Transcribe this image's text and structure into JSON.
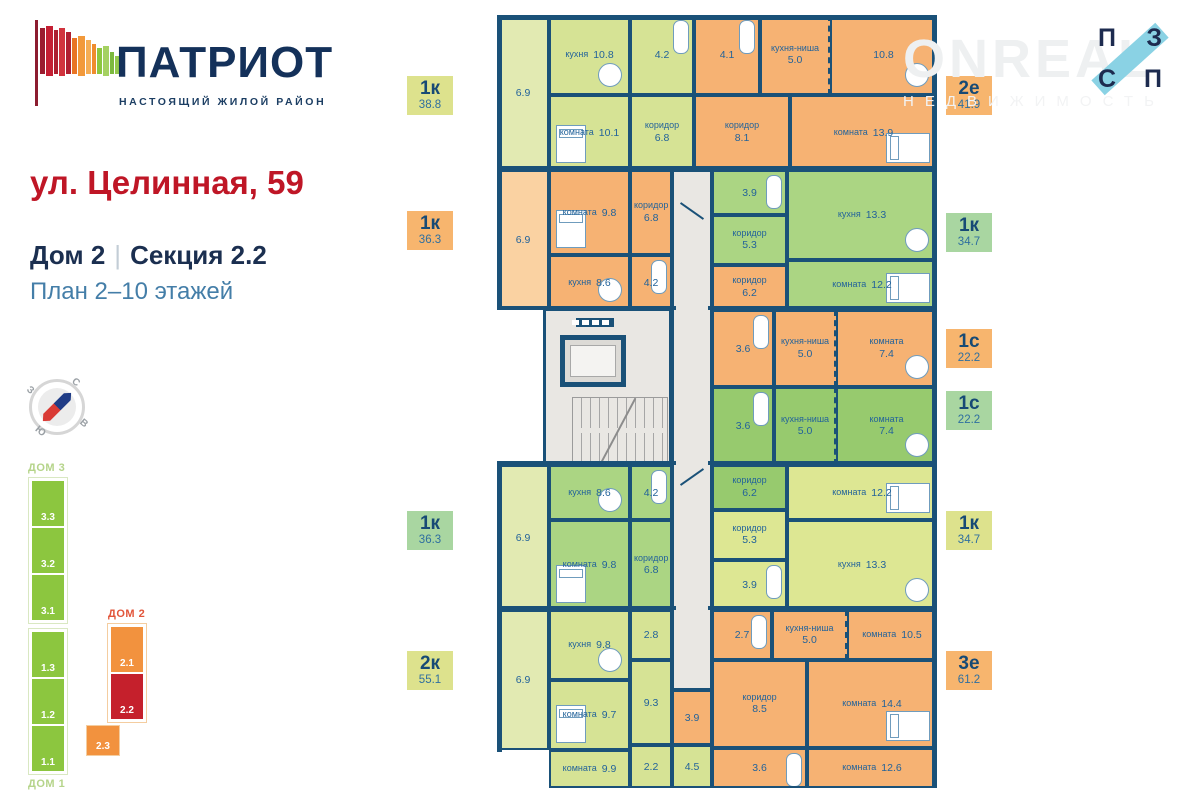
{
  "brand": {
    "name": "ПАТРИОТ",
    "tagline": "НАСТОЯЩИЙ ЖИЛОЙ РАЙОН",
    "flag_bars": [
      {
        "c": "#9b1c2f",
        "h": 46,
        "t": 8,
        "w": 5
      },
      {
        "c": "#c41f33",
        "h": 50,
        "t": 6,
        "w": 7
      },
      {
        "c": "#ad1e2f",
        "h": 44,
        "t": 10,
        "w": 4
      },
      {
        "c": "#d1343e",
        "h": 48,
        "t": 8,
        "w": 6
      },
      {
        "c": "#b01f31",
        "h": 42,
        "t": 12,
        "w": 5
      },
      {
        "c": "#e87424",
        "h": 36,
        "t": 18,
        "w": 5
      },
      {
        "c": "#f2993b",
        "h": 40,
        "t": 16,
        "w": 7
      },
      {
        "c": "#f5ad55",
        "h": 34,
        "t": 20,
        "w": 5
      },
      {
        "c": "#ef8c2e",
        "h": 30,
        "t": 24,
        "w": 4
      },
      {
        "c": "#8dc63f",
        "h": 26,
        "t": 28,
        "w": 5
      },
      {
        "c": "#a5d162",
        "h": 30,
        "t": 26,
        "w": 6
      },
      {
        "c": "#7cb93e",
        "h": 22,
        "t": 32,
        "w": 4
      },
      {
        "c": "#93c84c",
        "h": 18,
        "t": 36,
        "w": 5
      }
    ]
  },
  "title": {
    "address": "ул. Целинная, 59",
    "house": "Дом 2",
    "section": "Секция 2.2",
    "floors": "План 2–10 этажей"
  },
  "compass": {
    "n": "С",
    "e": "В",
    "s": "Ю",
    "w": "З"
  },
  "watermark": {
    "line1": "ONREAL",
    "line2": "НЕДВИЖИМОСТЬ"
  },
  "corner_logo": {
    "tl": "П",
    "tr": "З",
    "bl": "С",
    "br": "П",
    "band_color": "#8ad2e4"
  },
  "site_plan": {
    "dom3": {
      "label": "ДОМ 3",
      "sections": [
        "3.3",
        "3.2",
        "3.1"
      ]
    },
    "dom1": {
      "label": "ДОМ 1",
      "sections": [
        "1.3",
        "1.2",
        "1.1"
      ]
    },
    "dom2": {
      "label": "ДОМ 2",
      "sections_main": [
        "2.1",
        "2.2"
      ],
      "section_offset": "2.3",
      "highlight": "2.2",
      "color_normal": "#f2923e",
      "color_highlight": "#c5202c"
    }
  },
  "palette": {
    "y": "#d6e395",
    "yb": "#e2eab2",
    "o": "#f6b273",
    "ob": "#fad2a2",
    "g": "#abd583",
    "gs": "#97ca6e",
    "y2": "#dde793",
    "wall": "#1a5178",
    "text": "#23639a"
  },
  "tags_left": [
    {
      "t": "1к",
      "a": "38.8",
      "c": "#dde28d",
      "y": 76
    },
    {
      "t": "1к",
      "a": "36.3",
      "c": "#f7b56e",
      "y": 211
    },
    {
      "t": "1к",
      "a": "36.3",
      "c": "#a9d6a1",
      "y": 511
    },
    {
      "t": "2к",
      "a": "55.1",
      "c": "#dde28d",
      "y": 651
    }
  ],
  "tags_right": [
    {
      "t": "2е",
      "a": "41.9",
      "c": "#f7b56e",
      "y": 76
    },
    {
      "t": "1к",
      "a": "34.7",
      "c": "#a9d6a1",
      "y": 213
    },
    {
      "t": "1с",
      "a": "22.2",
      "c": "#f7b56e",
      "y": 329
    },
    {
      "t": "1с",
      "a": "22.2",
      "c": "#a9d6a1",
      "y": 391
    },
    {
      "t": "1к",
      "a": "34.7",
      "c": "#dde28d",
      "y": 511
    },
    {
      "t": "3е",
      "a": "61.2",
      "c": "#f7b56e",
      "y": 651
    }
  ],
  "plan": {
    "rooms": [
      {
        "a": "6.9",
        "x": 0,
        "y": 0,
        "w": 52,
        "h": 155,
        "f": "yb",
        "v": 1,
        "b": 1
      },
      {
        "n": "кухня",
        "a": "10.8",
        "x": 52,
        "y": 0,
        "w": 81,
        "h": 80,
        "f": "y",
        "furn": "table"
      },
      {
        "n": "комната",
        "a": "10.1",
        "x": 52,
        "y": 80,
        "w": 81,
        "h": 75,
        "f": "y",
        "furn": "bed"
      },
      {
        "a": "4.2",
        "x": 133,
        "y": 0,
        "w": 64,
        "h": 80,
        "f": "y",
        "furn": "bath"
      },
      {
        "n": "коридор",
        "a": "6.8",
        "x": 133,
        "y": 80,
        "w": 64,
        "h": 75,
        "f": "y",
        "v": 1
      },
      {
        "a": "4.1",
        "x": 197,
        "y": 0,
        "w": 66,
        "h": 80,
        "f": "o",
        "furn": "bath"
      },
      {
        "n": "кухня-ниша",
        "a": "5.0",
        "x": 263,
        "y": 0,
        "w": 70,
        "h": 80,
        "f": "o",
        "v": 1,
        "dash": 1
      },
      {
        "a": "10.8",
        "x": 333,
        "y": 0,
        "w": 107,
        "h": 80,
        "f": "o",
        "furn": "table"
      },
      {
        "n": "коридор",
        "a": "8.1",
        "x": 197,
        "y": 80,
        "w": 96,
        "h": 75,
        "f": "o",
        "v": 1
      },
      {
        "n": "комната",
        "a": "13.9",
        "x": 293,
        "y": 80,
        "w": 147,
        "h": 75,
        "f": "o",
        "furn": "bedh"
      },
      {
        "a": "6.9",
        "x": 0,
        "y": 155,
        "w": 52,
        "h": 140,
        "f": "ob",
        "v": 1,
        "b": 1
      },
      {
        "n": "комната",
        "a": "9.8",
        "x": 52,
        "y": 155,
        "w": 81,
        "h": 85,
        "f": "o",
        "furn": "bed"
      },
      {
        "n": "кухня",
        "a": "8.6",
        "x": 52,
        "y": 240,
        "w": 81,
        "h": 55,
        "f": "o",
        "furn": "table"
      },
      {
        "n": "коридор",
        "a": "6.8",
        "x": 133,
        "y": 155,
        "w": 42,
        "h": 85,
        "f": "o",
        "v": 1
      },
      {
        "a": "4.2",
        "x": 133,
        "y": 240,
        "w": 42,
        "h": 55,
        "f": "o",
        "furn": "bath"
      },
      {
        "a": "3.9",
        "x": 215,
        "y": 155,
        "w": 75,
        "h": 45,
        "f": "g",
        "furn": "bath"
      },
      {
        "n": "коридор",
        "a": "5.3",
        "x": 215,
        "y": 200,
        "w": 75,
        "h": 50,
        "f": "g",
        "v": 1
      },
      {
        "n": "кухня",
        "a": "13.3",
        "x": 290,
        "y": 155,
        "w": 150,
        "h": 90,
        "f": "g",
        "furn": "table"
      },
      {
        "n": "комната",
        "a": "12.2",
        "x": 290,
        "y": 245,
        "w": 150,
        "h": 50,
        "f": "g",
        "furn": "bedh"
      },
      {
        "n": "коридор",
        "a": "6.2",
        "x": 215,
        "y": 250,
        "w": 75,
        "h": 45,
        "f": "o",
        "v": 1
      },
      {
        "a": "3.6",
        "x": 215,
        "y": 295,
        "w": 62,
        "h": 77,
        "f": "o",
        "furn": "bath"
      },
      {
        "n": "кухня-ниша",
        "a": "5.0",
        "x": 277,
        "y": 295,
        "w": 62,
        "h": 77,
        "f": "o",
        "v": 1,
        "dash": 1
      },
      {
        "n": "комната",
        "a": "7.4",
        "x": 339,
        "y": 295,
        "w": 101,
        "h": 77,
        "f": "o",
        "v": 1,
        "furn": "table"
      },
      {
        "a": "3.6",
        "x": 215,
        "y": 372,
        "w": 62,
        "h": 78,
        "f": "gs",
        "furn": "bath"
      },
      {
        "n": "кухня-ниша",
        "a": "5.0",
        "x": 277,
        "y": 372,
        "w": 62,
        "h": 78,
        "f": "gs",
        "v": 1,
        "dash": 1
      },
      {
        "n": "комната",
        "a": "7.4",
        "x": 339,
        "y": 372,
        "w": 101,
        "h": 78,
        "f": "gs",
        "v": 1,
        "furn": "table"
      },
      {
        "a": "6.9",
        "x": 0,
        "y": 450,
        "w": 52,
        "h": 145,
        "f": "yb",
        "v": 1,
        "b": 1
      },
      {
        "n": "кухня",
        "a": "8.6",
        "x": 52,
        "y": 450,
        "w": 81,
        "h": 55,
        "f": "g",
        "furn": "table"
      },
      {
        "a": "4.2",
        "x": 133,
        "y": 450,
        "w": 42,
        "h": 55,
        "f": "g",
        "furn": "bath"
      },
      {
        "n": "комната",
        "a": "9.8",
        "x": 52,
        "y": 505,
        "w": 81,
        "h": 90,
        "f": "g",
        "furn": "bed"
      },
      {
        "n": "коридор",
        "a": "6.8",
        "x": 133,
        "y": 505,
        "w": 42,
        "h": 90,
        "f": "g",
        "v": 1
      },
      {
        "n": "коридор",
        "a": "6.2",
        "x": 215,
        "y": 450,
        "w": 75,
        "h": 45,
        "f": "gs",
        "v": 1
      },
      {
        "n": "коридор",
        "a": "5.3",
        "x": 215,
        "y": 495,
        "w": 75,
        "h": 50,
        "f": "y2",
        "v": 1
      },
      {
        "a": "3.9",
        "x": 215,
        "y": 545,
        "w": 75,
        "h": 50,
        "f": "y2",
        "furn": "bath"
      },
      {
        "n": "комната",
        "a": "12.2",
        "x": 290,
        "y": 450,
        "w": 150,
        "h": 55,
        "f": "y2",
        "furn": "bedh"
      },
      {
        "n": "кухня",
        "a": "13.3",
        "x": 290,
        "y": 505,
        "w": 150,
        "h": 90,
        "f": "y2",
        "furn": "table"
      },
      {
        "a": "6.9",
        "x": 0,
        "y": 595,
        "w": 52,
        "h": 140,
        "f": "yb",
        "v": 1,
        "b": 1
      },
      {
        "n": "кухня",
        "a": "9.8",
        "x": 52,
        "y": 595,
        "w": 81,
        "h": 70,
        "f": "y",
        "furn": "table"
      },
      {
        "a": "2.8",
        "x": 133,
        "y": 595,
        "w": 42,
        "h": 50,
        "f": "y"
      },
      {
        "n": "комната",
        "a": "9.7",
        "x": 52,
        "y": 665,
        "w": 81,
        "h": 70,
        "f": "y",
        "furn": "bed"
      },
      {
        "a": "9.3",
        "x": 133,
        "y": 645,
        "w": 42,
        "h": 85,
        "f": "y"
      },
      {
        "n": "комната",
        "a": "9.9",
        "x": 52,
        "y": 735,
        "w": 81,
        "h": 38,
        "f": "y"
      },
      {
        "a": "2.2",
        "x": 133,
        "y": 730,
        "w": 42,
        "h": 43,
        "f": "y"
      },
      {
        "a": "4.5",
        "x": 175,
        "y": 730,
        "w": 40,
        "h": 43,
        "f": "y"
      },
      {
        "a": "3.9",
        "x": 175,
        "y": 675,
        "w": 40,
        "h": 55,
        "f": "o"
      },
      {
        "a": "2.7",
        "x": 215,
        "y": 595,
        "w": 60,
        "h": 50,
        "f": "o",
        "furn": "bath"
      },
      {
        "n": "кухня-ниша",
        "a": "5.0",
        "x": 275,
        "y": 595,
        "w": 75,
        "h": 50,
        "f": "o",
        "v": 1,
        "dash": 1
      },
      {
        "n": "комната",
        "a": "10.5",
        "x": 350,
        "y": 595,
        "w": 90,
        "h": 50,
        "f": "o"
      },
      {
        "n": "коридор",
        "a": "8.5",
        "x": 215,
        "y": 645,
        "w": 95,
        "h": 88,
        "f": "o",
        "v": 1
      },
      {
        "n": "комната",
        "a": "14.4",
        "x": 310,
        "y": 645,
        "w": 130,
        "h": 88,
        "f": "o",
        "furn": "bedh"
      },
      {
        "a": "3.6",
        "x": 215,
        "y": 733,
        "w": 95,
        "h": 40,
        "f": "o",
        "furn": "bath"
      },
      {
        "n": "комната",
        "a": "12.6",
        "x": 310,
        "y": 733,
        "w": 130,
        "h": 40,
        "f": "o"
      }
    ]
  }
}
